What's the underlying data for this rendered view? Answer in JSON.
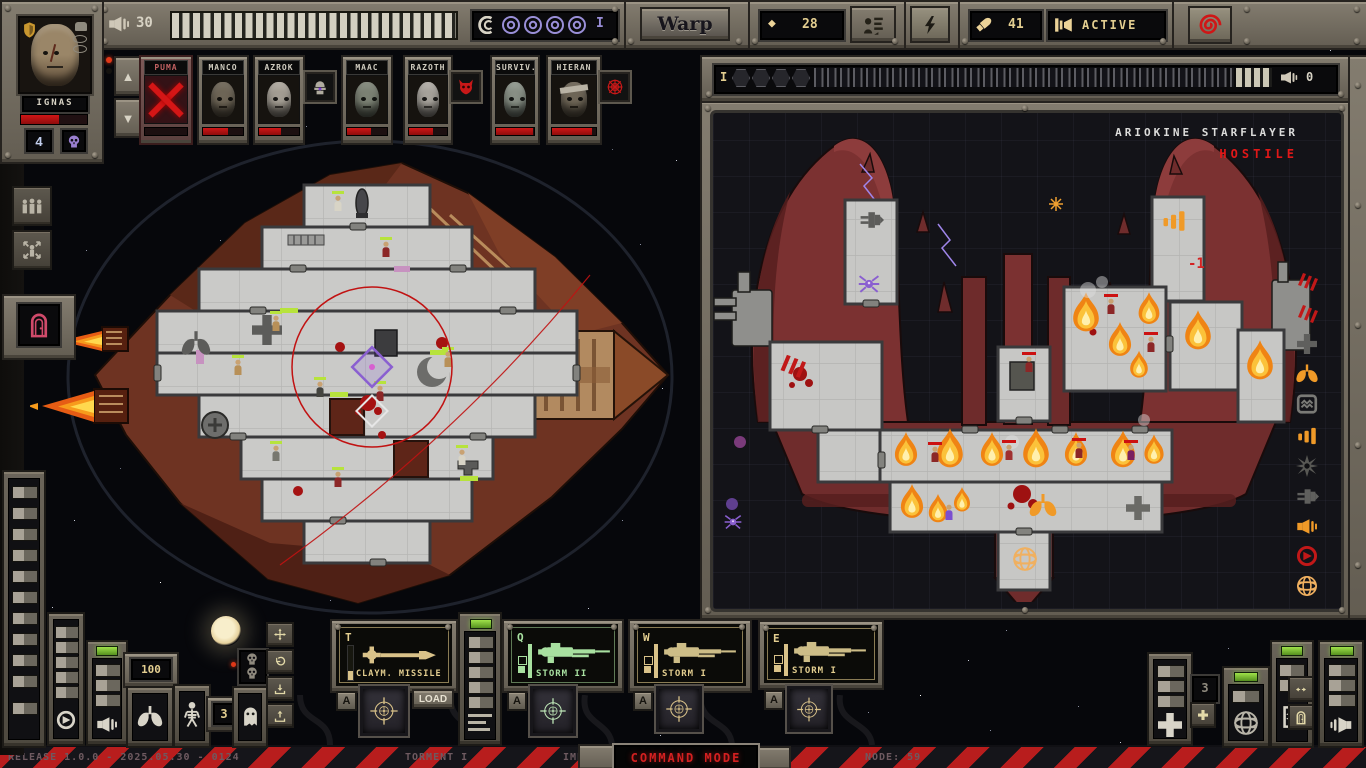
{
  "top_bar": {
    "player_hull": {
      "icon": "speaker-horn-icon",
      "value": "30",
      "segments_total": 27,
      "segments_filled": 27
    },
    "warp_drive": {
      "icon": "warp-horn-icon",
      "charges": 4,
      "tick": "I"
    },
    "warp_button_label": "Warp",
    "scrap": {
      "icon": "diamond-icon",
      "value": "28"
    },
    "crew_orders_icon": "crew-orders-icon",
    "power_icon": "lightning-icon",
    "ammo": {
      "icon": "shell-icon",
      "value": "41"
    },
    "alert": {
      "icon": "siren-icon",
      "value": "ACTIVE"
    },
    "chaos_button_icon": "chaos-spiral-icon"
  },
  "captain": {
    "name": "IGNAS",
    "reserve_count": "4",
    "hp_percent": 57,
    "badges": [
      "shield-badge-icon",
      "helmet-icon",
      "eye-icon",
      "eye-icon"
    ],
    "skull_button_icon": "skull-icon"
  },
  "crew": [
    {
      "name": "PUMA",
      "status": "dead",
      "hp_percent": 0
    },
    {
      "name": "MANCO",
      "status": "alive",
      "hp_percent": 62
    },
    {
      "name": "AZROK",
      "status": "alive",
      "hp_percent": 55,
      "companion": "servitor-icon"
    },
    {
      "name": "MAAC",
      "status": "alive",
      "hp_percent": 60
    },
    {
      "name": "RAZOTH",
      "status": "alive",
      "hp_percent": 62,
      "companion": "daemon-icon"
    },
    {
      "name": "SURVIV.",
      "status": "alive",
      "hp_percent": 97
    },
    {
      "name": "HIERAN V",
      "status": "alive",
      "hp_percent": 92,
      "companion": "web-icon"
    }
  ],
  "left_controls": {
    "group_icon": "crew-group-icon",
    "spread_icon": "crew-spread-icon",
    "door_icon": "door-icon"
  },
  "enemy_panel": {
    "ship_name": "ARIOKINE STARFLAYER",
    "status": "HOSTILE",
    "hull_bar": {
      "tick": "I",
      "hex_slots": 4,
      "segments_total": 44,
      "segments_filled": 4,
      "value": "0"
    },
    "weapon_debuff": "-1",
    "status_icons": [
      "claw-marks-icon",
      "claw-marks-icon",
      "medbay-cross-icon",
      "oxygen-lungs-icon",
      "shield-generator-icon",
      "signal-bars-icon",
      "burst-icon",
      "engine-icon",
      "horn-icon",
      "retreat-arrow-icon",
      "cage-sphere-icon"
    ]
  },
  "weapons": {
    "a_label": "A",
    "slots": [
      {
        "hotkey": "T",
        "name": "CLAYM. MISSILE",
        "action": "LOAD"
      },
      {
        "hotkey": "Q",
        "name": "STORM II"
      },
      {
        "hotkey": "W",
        "name": "STORM I"
      },
      {
        "hotkey": "E",
        "name": "STORM I"
      }
    ]
  },
  "bottom_consoles": {
    "oxygen_value": "100",
    "crew_reserve_value": "3",
    "assault_value": "3",
    "icons": [
      "rotate-icon",
      "thruster-icon",
      "lungs-icon",
      "skeleton-icon",
      "ghost-icon",
      "move-crosshair-icon",
      "undo-arrow-icon",
      "drop-icon",
      "lift-icon",
      "medical-cross-icon",
      "add-plus-icon",
      "shield-sphere-icon",
      "coil-icon",
      "swap-arrows-icon",
      "door-small-icon",
      "horn-icon"
    ]
  },
  "status_bar": {
    "release": "RELEASE 1.0.0 - 2025.05.30 - 0124",
    "difficulty": "TORMENT I",
    "sector": "IMPERIAL COREWORLDS 6",
    "node": "NODE: 59",
    "mode": "COMMAND MODE"
  },
  "colors": {
    "accent_tan": "#e3ce90",
    "alert_red": "#d42222",
    "hostile_red": "#e01818",
    "warp_purple": "#9a8fd8",
    "fire_orange": "#f39a1e",
    "screen_green": "#a8e0a0",
    "led_green": "#7ed321"
  }
}
